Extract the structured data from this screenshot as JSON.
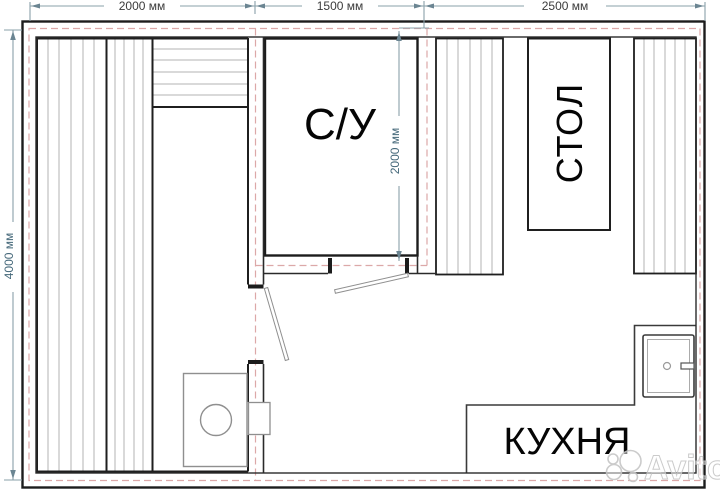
{
  "plan": {
    "labels": {
      "bathroom": "С/У",
      "table": "СТОЛ",
      "kitchen": "КУХНЯ"
    },
    "dimensions": {
      "top_segments": [
        "2000 мм",
        "1500 мм",
        "2500 мм"
      ],
      "left_height": "4000 мм",
      "bathroom_height": "2000 мм"
    },
    "colors": {
      "wall": "#1c1c1c",
      "insulation_dash": "#dca8a8",
      "dimension_line": "#8aa0aa",
      "hatch": "#b3b3b3"
    }
  },
  "watermark": {
    "brand": "Avito"
  }
}
